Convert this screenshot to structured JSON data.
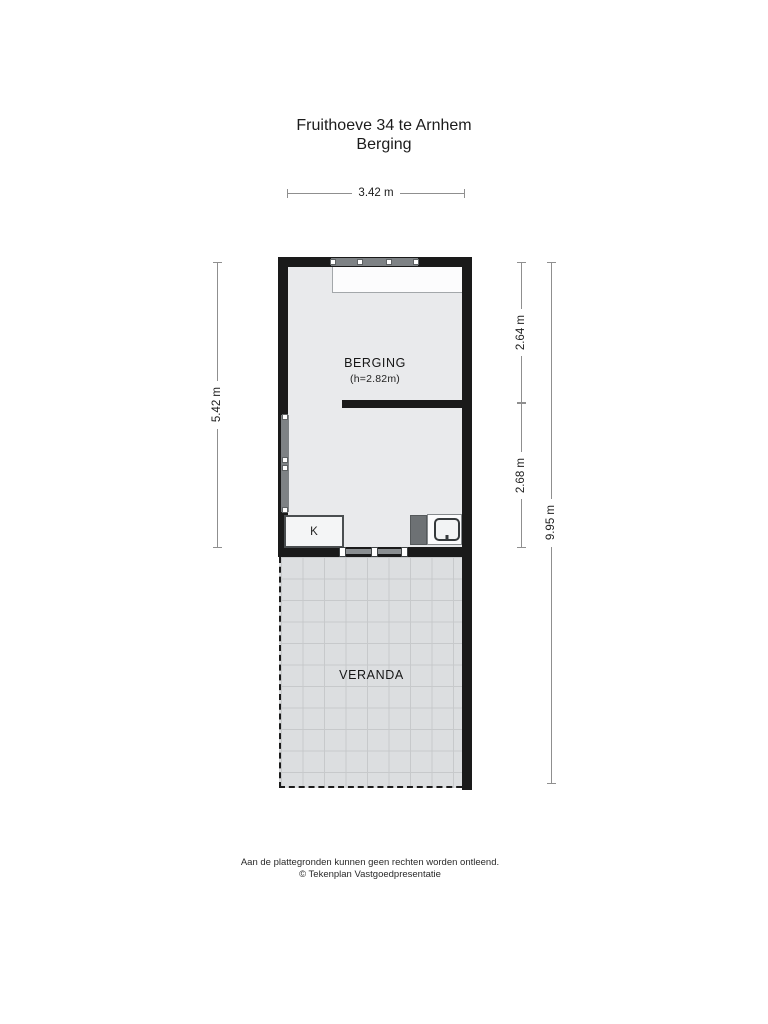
{
  "title": {
    "line1": "Fruithoeve 34 te Arnhem",
    "line2": "Berging"
  },
  "rooms": {
    "berging": {
      "name": "BERGING",
      "height_note": "(h=2.82m)"
    },
    "veranda": {
      "name": "VERANDA"
    },
    "closet": {
      "label": "K"
    }
  },
  "dimensions": {
    "top_width": "3.42 m",
    "left_height": "5.42 m",
    "right_upper": "2.64 m",
    "right_lower": "2.68 m",
    "right_total": "9.95 m"
  },
  "footer": {
    "line1": "Aan de plattegronden kunnen geen rechten worden ontleend.",
    "line2": "© Tekenplan Vastgoedpresentatie"
  },
  "colors": {
    "wall": "#1a1a1a",
    "floor": "#e9eaec",
    "veranda": "#dcdee0",
    "grid": "#c7c9cb",
    "winframe": "#7e8285",
    "cabinet": "#6d7174",
    "dim": "#8f8f8f",
    "ink": "#1f1f1f",
    "fixture": "#fbfbfc"
  }
}
